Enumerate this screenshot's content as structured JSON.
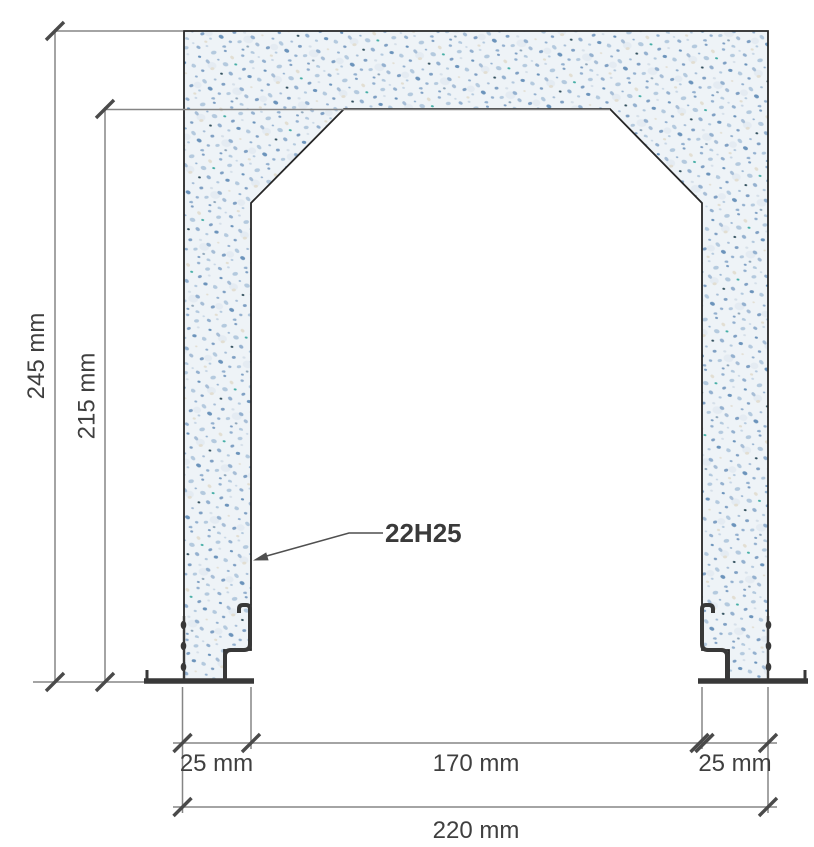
{
  "diagram": {
    "title_hint": "concrete portal frame cross-section",
    "dimensions": {
      "total_height": "245 mm",
      "inner_height": "215 mm",
      "wall_left": "25 mm",
      "opening_width": "170 mm",
      "wall_right": "25 mm",
      "total_width": "220 mm"
    },
    "annotation": {
      "rebar": "22H25"
    },
    "colors": {
      "concrete_base": "#eef3f7",
      "concrete_speckle_blue": "#93b0cf",
      "outline": "#262626",
      "dimension_line": "#858585",
      "tick": "#4a4a4a",
      "steel_hardware": "#383838",
      "label_text": "#3f3f3f"
    }
  }
}
